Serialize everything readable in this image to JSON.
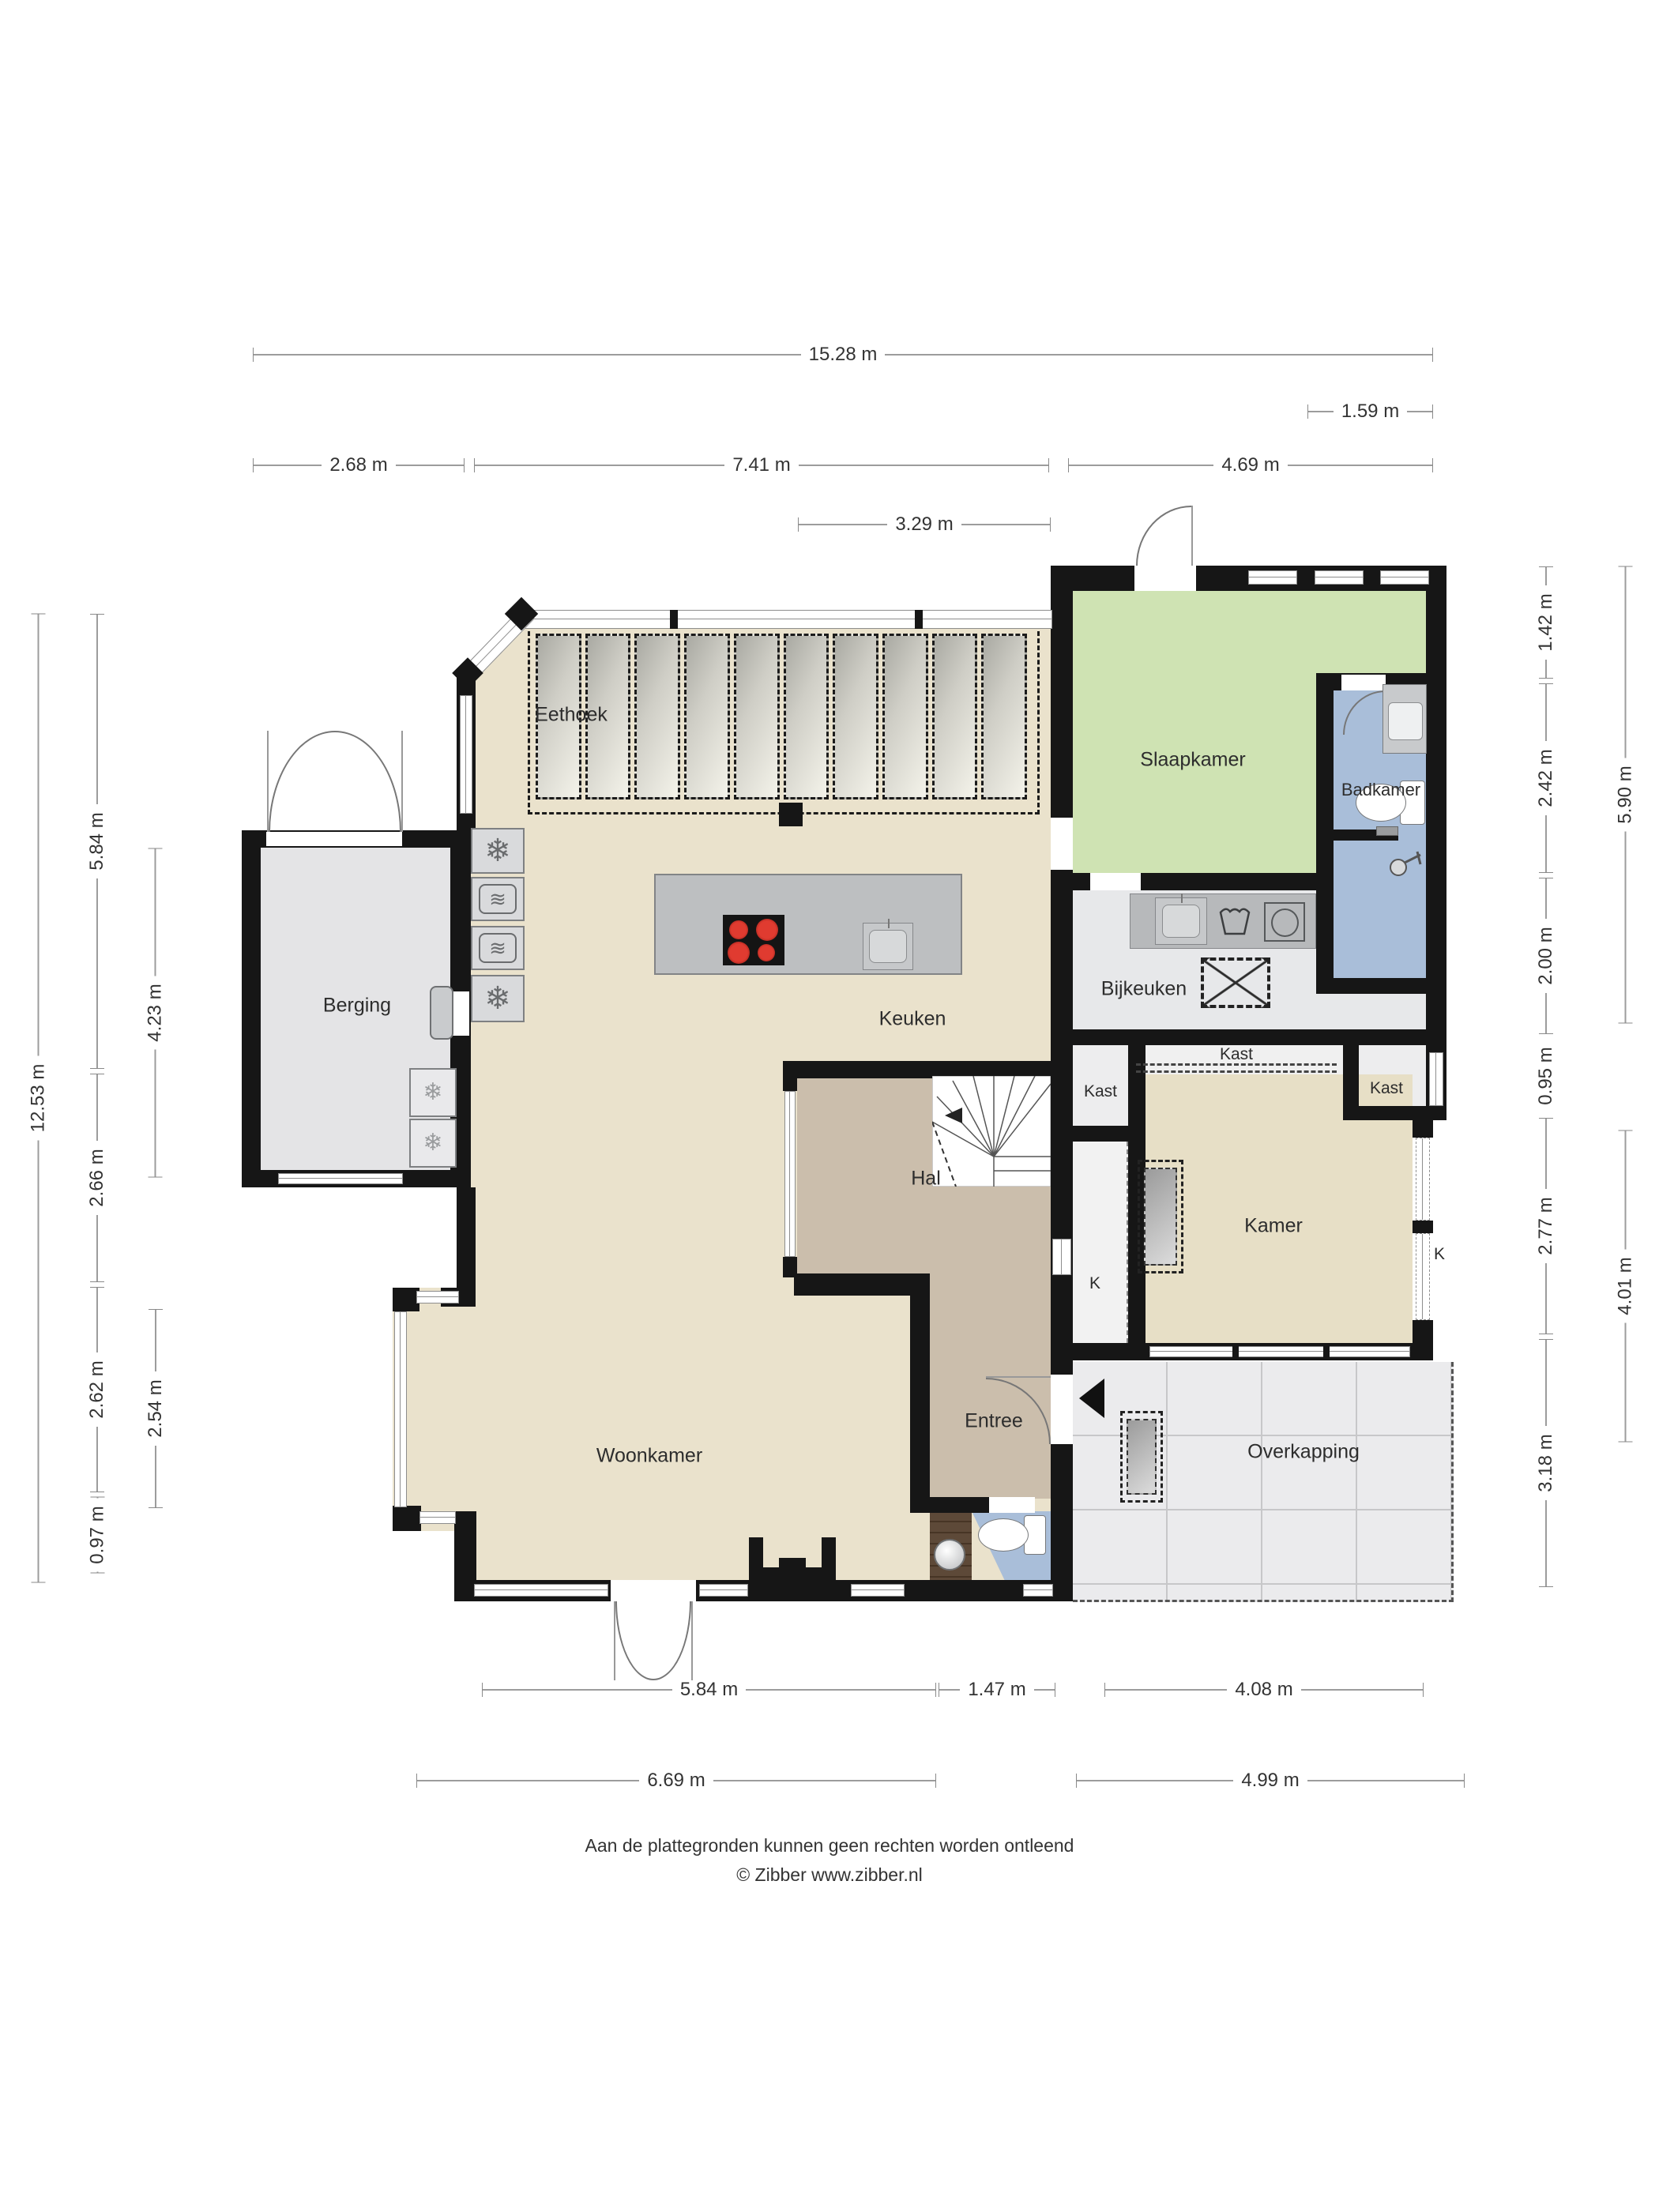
{
  "rooms": {
    "eethoek": "Eethoek",
    "slaapkamer": "Slaapkamer",
    "badkamer": "Badkamer",
    "berging": "Berging",
    "bijkeuken": "Bijkeuken",
    "keuken": "Keuken",
    "kast_top": "Kast",
    "kast_left": "Kast",
    "kast_right": "Kast",
    "hal": "Hal",
    "kamer": "Kamer",
    "k_left": "K",
    "k_right": "K",
    "woonkamer": "Woonkamer",
    "entree": "Entree",
    "overkapping": "Overkapping"
  },
  "dimensions": {
    "top_total": "15.28 m",
    "top_right_small": "1.59 m",
    "top_berging": "2.68 m",
    "top_keuken": "7.41 m",
    "top_wing": "4.69 m",
    "top_eethoek": "3.29 m",
    "left_total": "12.53 m",
    "left_upper": "5.84 m",
    "left_mid": "2.66 m",
    "left_lower": "2.62 m",
    "left_bottom": "0.97 m",
    "left_berging": "4.23 m",
    "left_bay": "2.54 m",
    "right_1": "1.42 m",
    "right_2": "2.42 m",
    "right_3": "2.00 m",
    "right_4": "0.95 m",
    "right_5": "2.77 m",
    "right_6": "3.18 m",
    "right_wing_total": "5.90 m",
    "right_lower_total": "4.01 m",
    "bottom_woonkamer": "5.84 m",
    "bottom_entree": "1.47 m",
    "bottom_overkapping": "4.08 m",
    "bottom_left_total": "6.69 m",
    "bottom_right_total": "4.99 m"
  },
  "footer": {
    "line1": "Aan de plattegronden kunnen geen rechten worden ontleend",
    "line2": "© Zibber www.zibber.nl"
  },
  "icons": {
    "freezer": "❄",
    "oven": "≋"
  },
  "colors": {
    "wall": "#161616",
    "living": "#eae2cc",
    "hall": "#cbbeac",
    "bedroom": "#cfe3b3",
    "bath": "#a9bed9",
    "storage": "#e4e4e6",
    "utility": "#e7e8ea",
    "canopy": "#ebebed",
    "counter": "#b7b9bb",
    "island": "#bdbfc1"
  }
}
